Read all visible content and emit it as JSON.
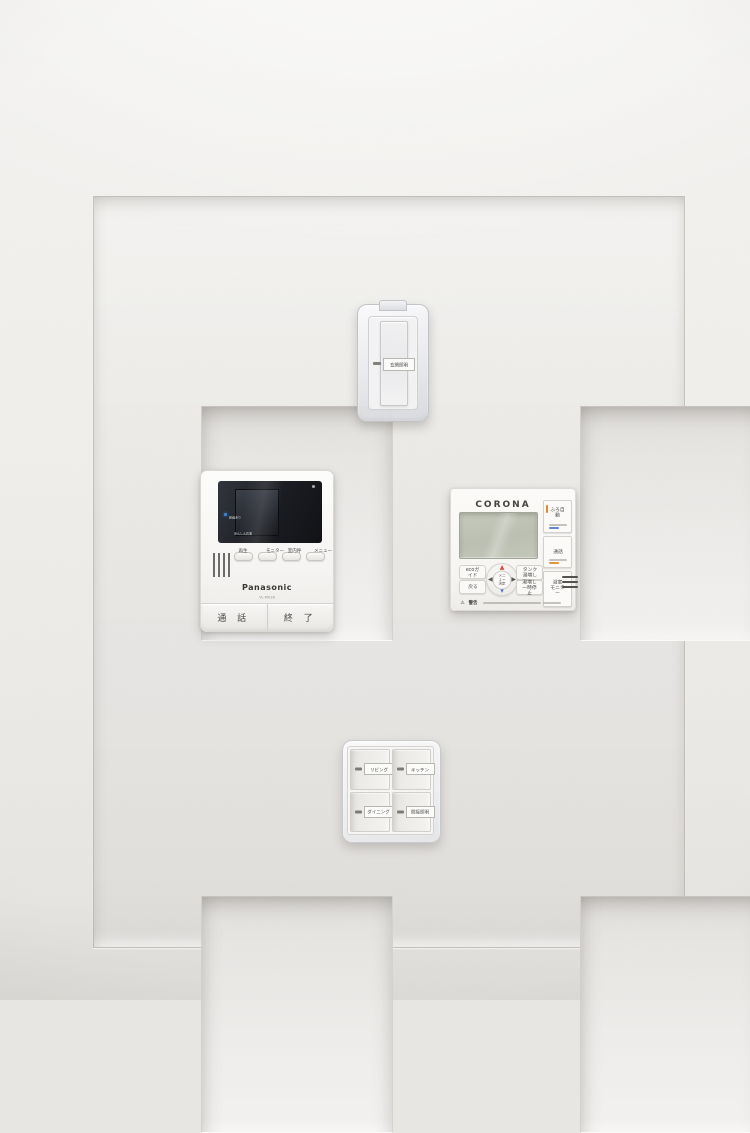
{
  "colors": {
    "accent_orange": "#e08a2e",
    "led_blue": "#3f8be0",
    "arrow_red": "#cf4a3c",
    "arrow_blue": "#3a6fc4",
    "lcd_green": "#c0c4b6"
  },
  "covered_switch": {
    "label": "玄関照明"
  },
  "intercom": {
    "brand": "Panasonic",
    "model": "VL-MV28",
    "indicators": [
      "録画あり",
      "あんしん応答"
    ],
    "buttons_small": [
      "再生",
      "モニター",
      "室内呼",
      "メニュー"
    ],
    "button_talk": "通 話",
    "button_end": "終 了"
  },
  "remote": {
    "brand": "CORONA",
    "side_buttons": [
      "ふろ自動",
      "通話",
      "浴室\nモニター"
    ],
    "left_buttons": [
      "ecoガイド",
      "戻る"
    ],
    "dpad": {
      "up": "▲",
      "down": "▼",
      "left": "◀",
      "right": "▶",
      "center": "メニュー\n決定"
    },
    "right_buttons": [
      "タンク\n湯増し",
      "湯増し\n一時停止"
    ],
    "warning_icon": "⚠",
    "warning_label": "警告"
  },
  "switch_panel": {
    "labels": [
      "リビング",
      "キッチン",
      "ダイニング",
      "間接照明"
    ]
  }
}
